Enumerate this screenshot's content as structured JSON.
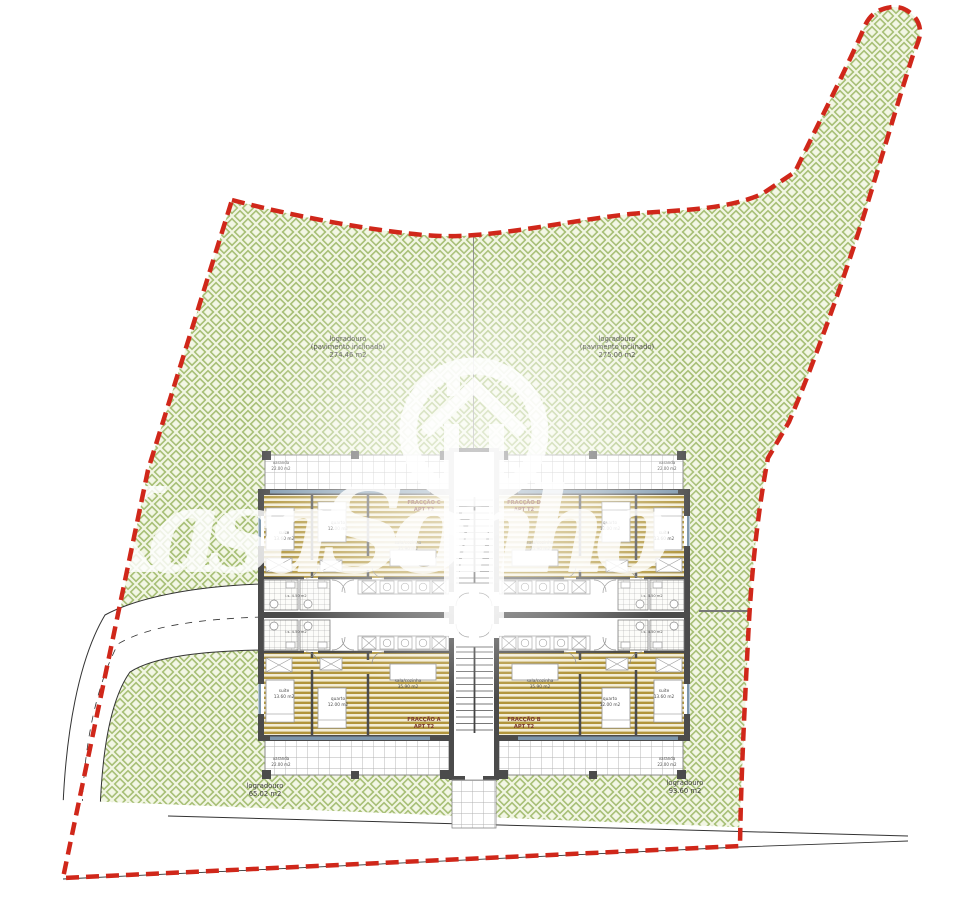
{
  "colors": {
    "boundary_red": "#d0271a",
    "landscape_green_line": "#a8c077",
    "landscape_green_bg": "#f2f6e4",
    "wall_gray": "#4b4b4b",
    "wood_floor": "#b1953c",
    "window_blue": "#7d97ac",
    "unit_label_brown": "#7a382b",
    "watermark_white": "#ffffff"
  },
  "site": {
    "area_labels": [
      {
        "name": "logradouro-nw",
        "line1": "logradouro",
        "line2": "(pavimento inclinado)",
        "line3": "274.46 m2"
      },
      {
        "name": "logradouro-ne",
        "line1": "logradouro",
        "line2": "(pavimento inclinado)",
        "line3": "275.00 m2"
      },
      {
        "name": "logradouro-sw",
        "line1": "logradouro",
        "line2": "65.02 m2"
      },
      {
        "name": "logradouro-se",
        "line1": "logradouro",
        "line2": "93.60 m2"
      }
    ]
  },
  "building": {
    "units": [
      {
        "fraction": "FRACÇÃO C",
        "apt": "APT T2",
        "suite_name": "suite",
        "suite_area": "13.60 m2",
        "quarto_name": "quarto",
        "quarto_area": "12.00 m2",
        "sala_name": "sala/cozinha",
        "sala_area": "35.90 m2",
        "varanda_name": "varanda",
        "varanda_area": "22.00 m2",
        "is_label": "i.s. 4.50 m2"
      },
      {
        "fraction": "FRACÇÃO D",
        "apt": "APT T2",
        "suite_name": "suite",
        "suite_area": "13.60 m2",
        "quarto_name": "quarto",
        "quarto_area": "12.00 m2",
        "sala_name": "sala/cozinha",
        "sala_area": "35.90 m2",
        "varanda_name": "varanda",
        "varanda_area": "22.00 m2",
        "is_label": "i.s. 4.50 m2"
      },
      {
        "fraction": "FRACÇÃO A",
        "apt": "APT T2",
        "suite_name": "suite",
        "suite_area": "13.60 m2",
        "quarto_name": "quarto",
        "quarto_area": "12.00 m2",
        "sala_name": "sala/cozinha",
        "sala_area": "35.90 m2",
        "varanda_name": "varanda",
        "varanda_area": "22.00 m2",
        "is_label": "i.s. 4.50 m2"
      },
      {
        "fraction": "FRACÇÃO B",
        "apt": "APT T2",
        "suite_name": "suite",
        "suite_area": "13.60 m2",
        "quarto_name": "quarto",
        "quarto_area": "12.00 m2",
        "sala_name": "sala/cozinha",
        "sala_area": "35.90 m2",
        "varanda_name": "varanda",
        "varanda_area": "22.00 m2",
        "is_label": "i.s. 4.50 m2"
      }
    ]
  },
  "watermark": {
    "brand": "KasaSonho"
  }
}
